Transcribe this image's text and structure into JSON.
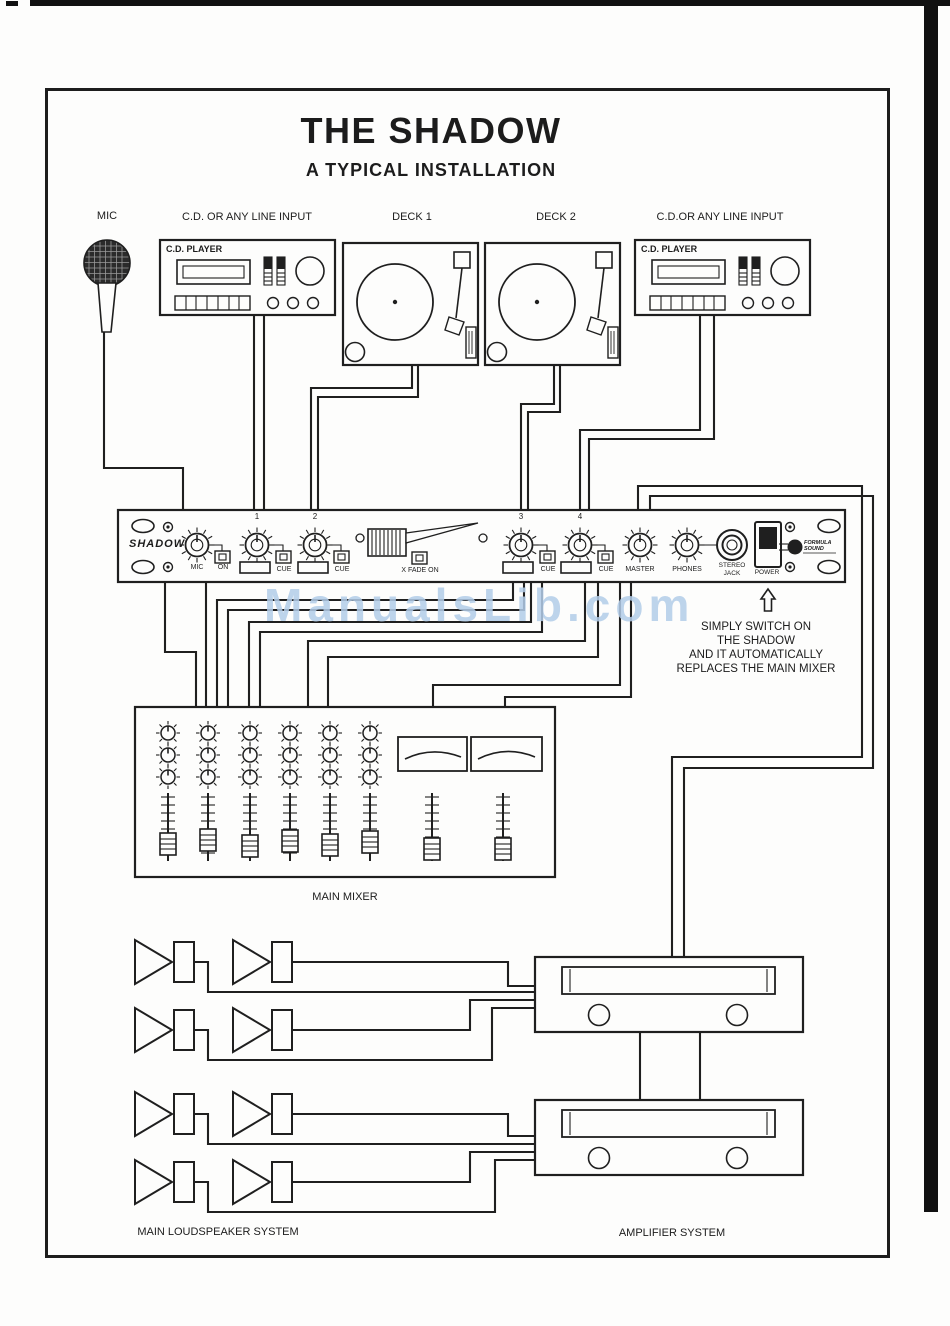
{
  "page": {
    "title": "THE SHADOW",
    "subtitle": "A TYPICAL INSTALLATION",
    "watermark": "ManualsLib.com"
  },
  "input_labels": {
    "mic": "MIC",
    "cd_left": "C.D. OR ANY LINE INPUT",
    "deck1": "DECK 1",
    "deck2": "DECK 2",
    "cd_right": "C.D.OR ANY LINE INPUT"
  },
  "cd_player_label": "C.D. PLAYER",
  "mixer": {
    "brand": "SHADOW",
    "channels": [
      "1",
      "2",
      "3",
      "4"
    ],
    "labels": {
      "mic": "MIC",
      "on": "ON",
      "cue": "CUE",
      "xfade": "X FADE ON",
      "master": "MASTER",
      "phones": "PHONES",
      "jack1": "STEREO",
      "jack2": "JACK",
      "power": "POWER",
      "logo1": "FORMULA",
      "logo2": "SOUND"
    }
  },
  "note": {
    "l1": "SIMPLY SWITCH ON",
    "l2": "THE SHADOW",
    "l3": "AND IT AUTOMATICALLY",
    "l4": "REPLACES THE MAIN MIXER"
  },
  "captions": {
    "main_mixer": "MAIN MIXER",
    "speakers": "MAIN LOUDSPEAKER SYSTEM",
    "amps": "AMPLIFIER SYSTEM"
  },
  "colors": {
    "ink": "#1f1f1f",
    "watermark": "#b3cde9"
  }
}
